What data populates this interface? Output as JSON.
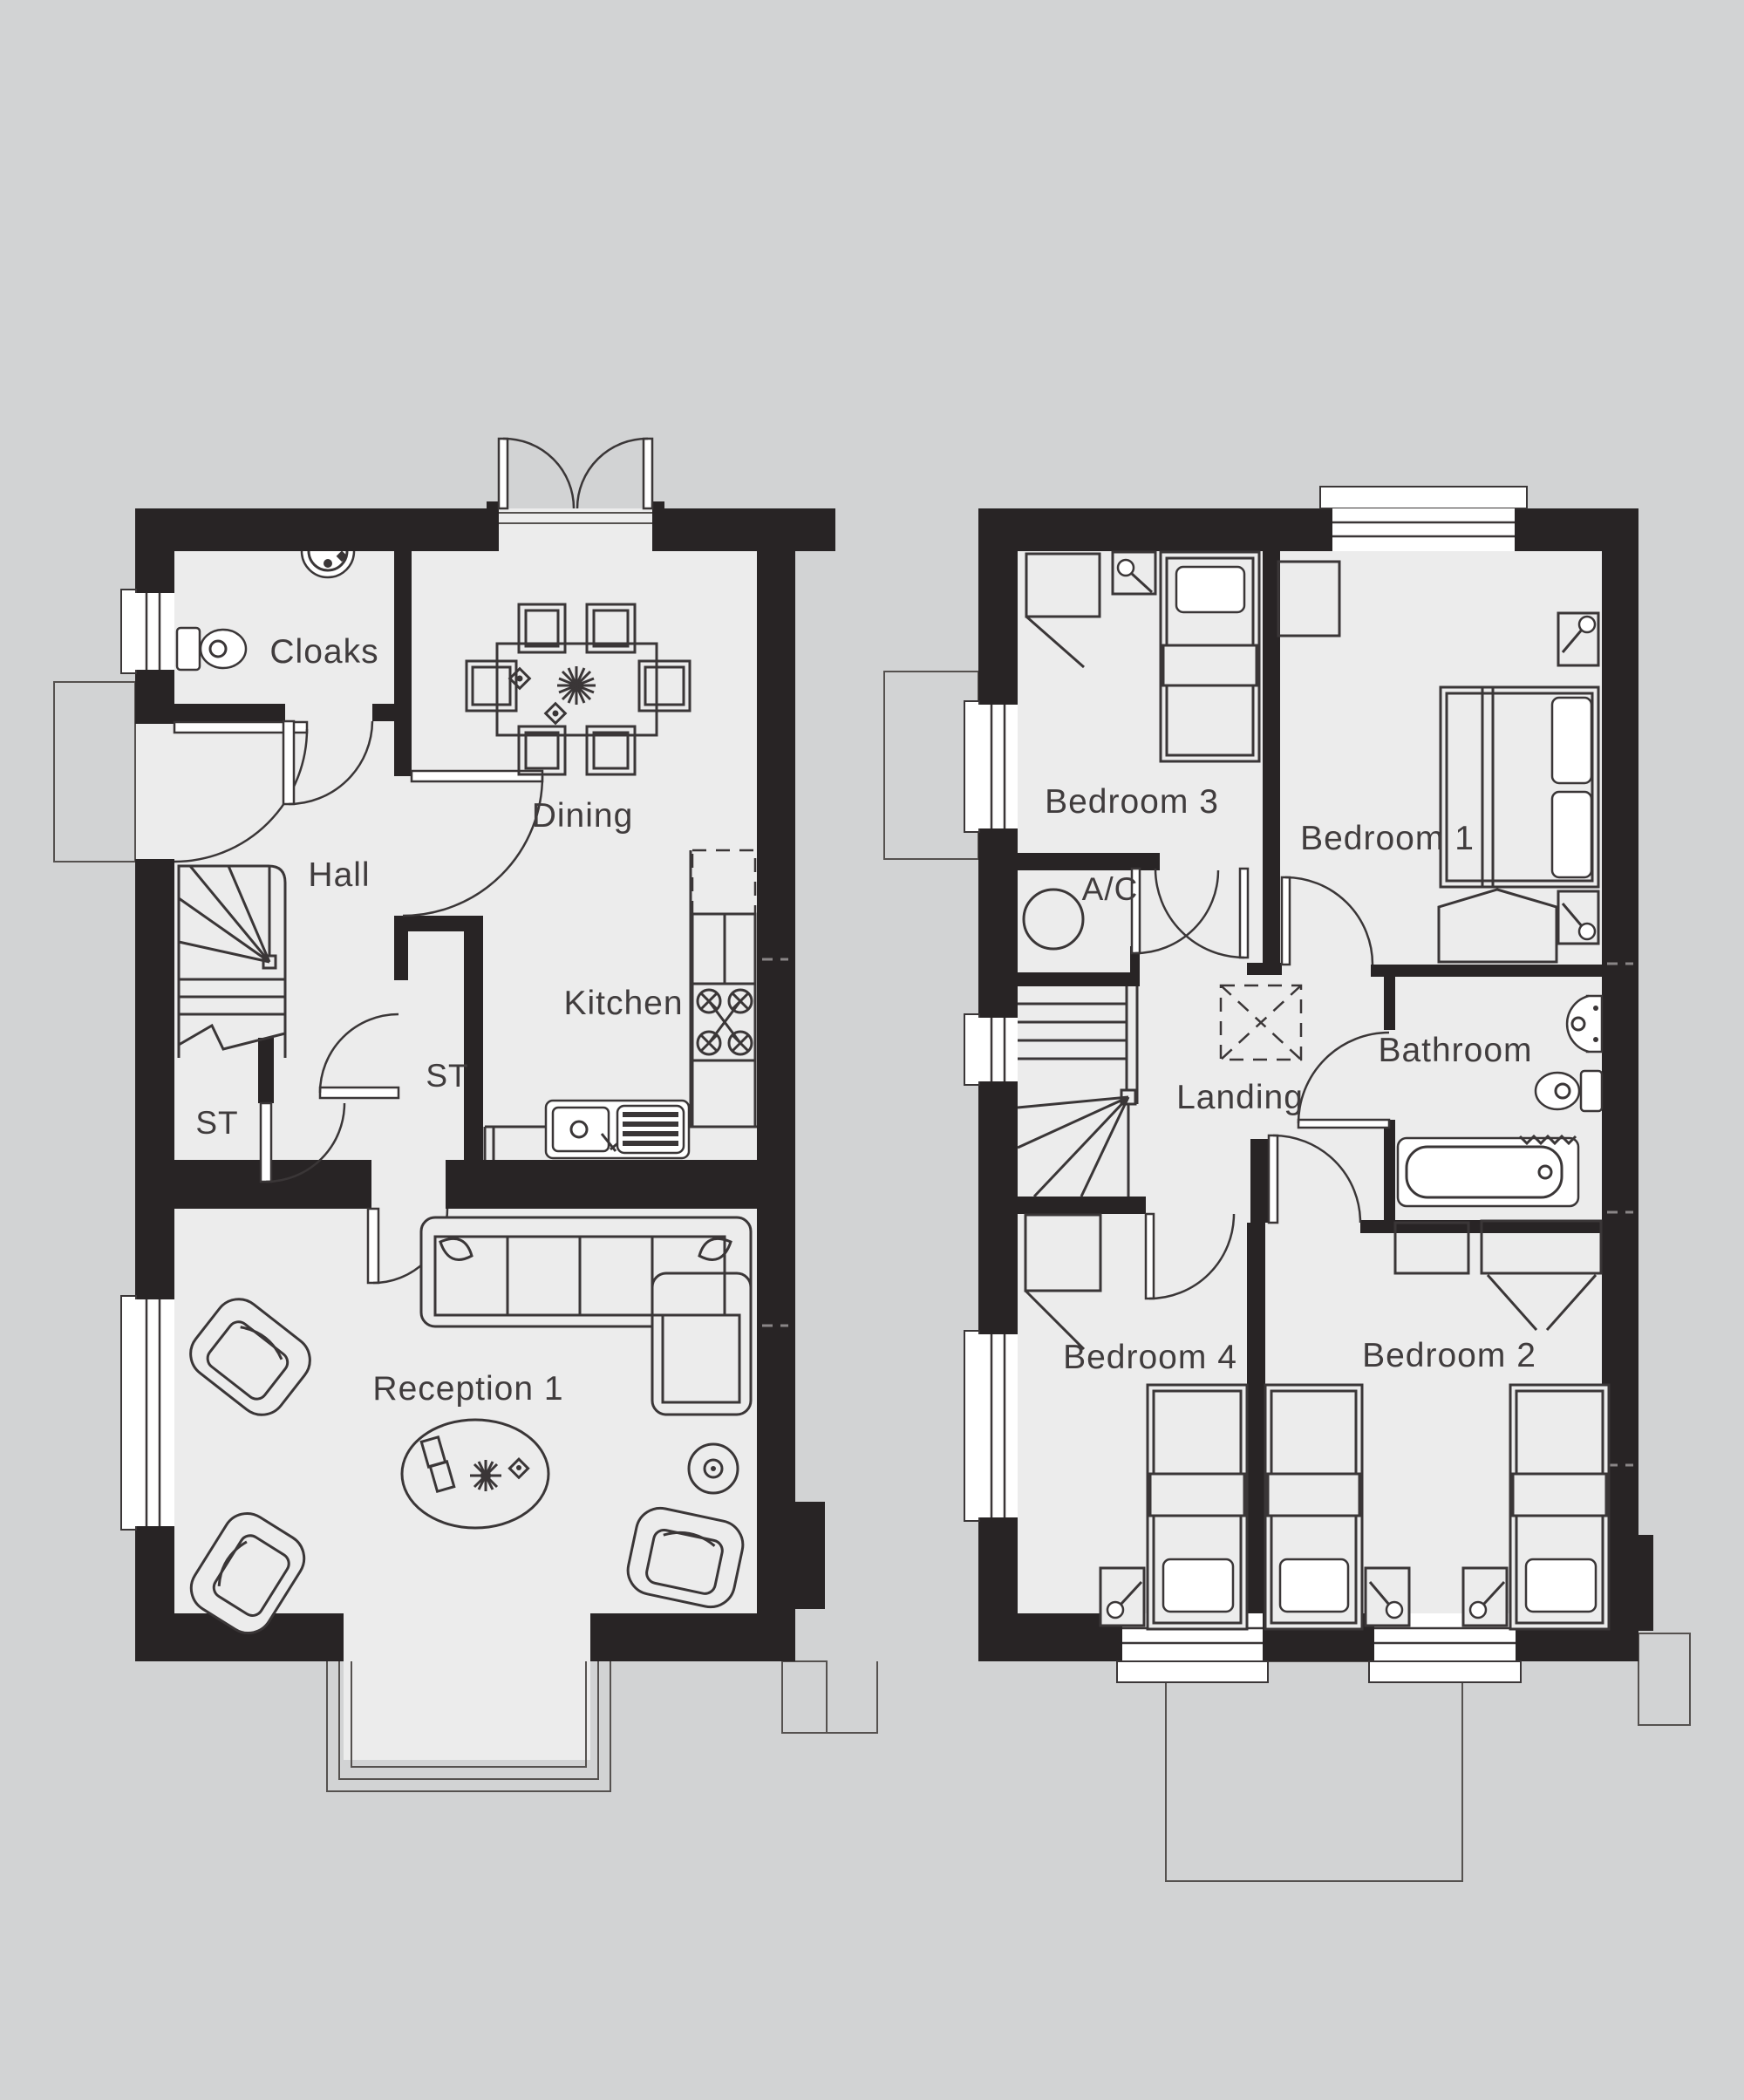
{
  "document": {
    "type": "floor-plan-drawing",
    "floors": [
      "ground-floor",
      "first-floor"
    ]
  },
  "colors": {
    "background": "#d2d3d4",
    "floor_fill": "#ececec",
    "wall": "#282425",
    "furniture_line": "#3a3637",
    "label_text": "#403c3d"
  },
  "ground_floor": {
    "labels": {
      "cloaks": "Cloaks",
      "dining": "Dining",
      "hall": "Hall",
      "kitchen": "Kitchen",
      "st_understairs": "ST",
      "st_cupboard": "ST",
      "reception": "Reception 1"
    },
    "fixtures": [
      "toilet-icon",
      "basin-icon",
      "dining-table-icon",
      "dining-chair-icon",
      "stairs-icon",
      "fridge-space-dashed-icon",
      "hob-icon",
      "kitchen-sink-icon",
      "corner-sofa-icon",
      "armchair-icon",
      "rug-icon",
      "coffee-table-icon",
      "side-table-icon",
      "french-doors-icon",
      "bay-window-icon",
      "porch-canopy-icon"
    ]
  },
  "first_floor": {
    "labels": {
      "bedroom3": "Bedroom 3",
      "bedroom1": "Bedroom 1",
      "ac": "A/C",
      "landing": "Landing",
      "bathroom": "Bathroom",
      "bedroom4": "Bedroom 4",
      "bedroom2": "Bedroom 2"
    },
    "fixtures": [
      "single-bed-icon",
      "double-bed-icon",
      "wardrobe-icon",
      "bedside-table-lamp-icon",
      "hot-water-cylinder-icon",
      "stairs-icon",
      "loft-hatch-icon",
      "bath-icon",
      "basin-icon",
      "toilet-icon",
      "window-icon"
    ]
  }
}
